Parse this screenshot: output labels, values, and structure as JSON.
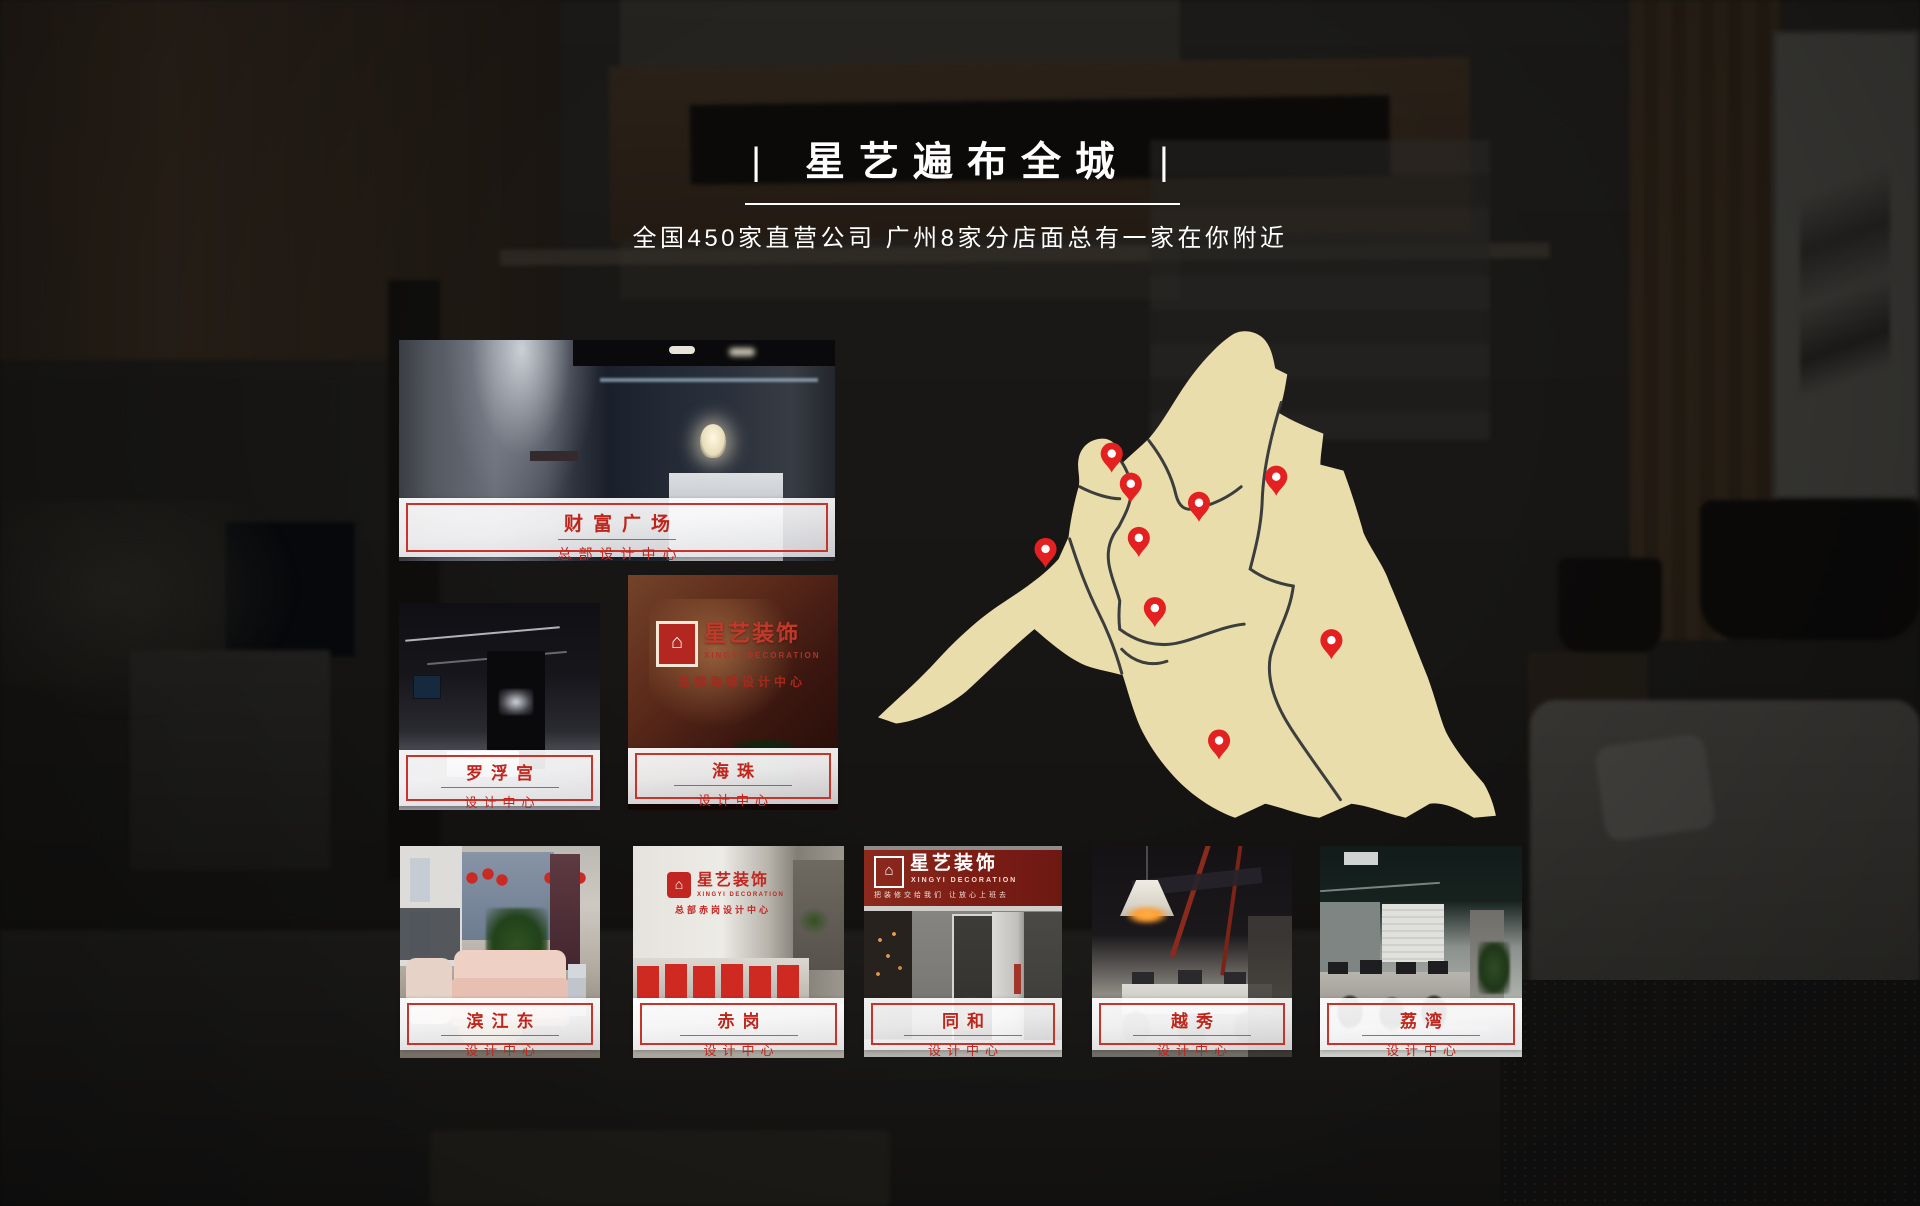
{
  "header": {
    "pipe": "|",
    "title": "星艺遍布全城",
    "subtitle": "全国450家直营公司 广州8家分店面总有一家在你附近"
  },
  "colors": {
    "accent_red": "#c0251c",
    "label_border_red": "#c5352c",
    "map_beige": "#e9ddab",
    "pin_red": "#e32121",
    "title_white": "#ffffff"
  },
  "stores": [
    {
      "name": "财富广场",
      "type": "总部设计中心"
    },
    {
      "name": "罗浮宫",
      "type": "设计中心"
    },
    {
      "name": "海珠",
      "type": "设计中心"
    },
    {
      "name": "滨江东",
      "type": "设计中心"
    },
    {
      "name": "赤岗",
      "type": "设计中心"
    },
    {
      "name": "同和",
      "type": "设计中心"
    },
    {
      "name": "越秀",
      "type": "设计中心"
    },
    {
      "name": "荔湾",
      "type": "设计中心"
    }
  ],
  "map": {
    "pins": 9
  },
  "photo_signs": {
    "haizhu": {
      "brand": "星艺装饰",
      "brand_en": "XINGYI DECORATION",
      "sub": "总部海珠设计中心"
    },
    "chigang": {
      "brand": "星艺装饰",
      "brand_en": "XINGYI DECORATION",
      "sub": "总部赤岗设计中心"
    },
    "tonghe": {
      "brand": "星艺装饰",
      "brand_en": "XINGYI DECORATION",
      "slogan": "把装修交给我们 让放心上班去"
    }
  }
}
